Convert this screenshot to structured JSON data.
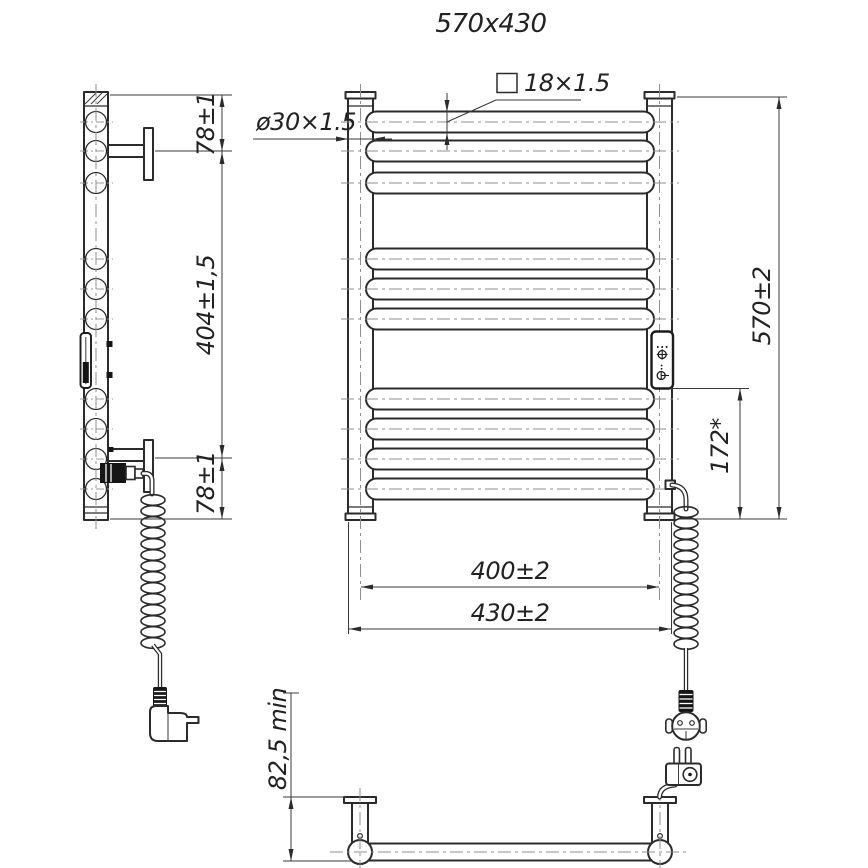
{
  "title": "570x430",
  "drawing": {
    "labels": {
      "tube_section": "18×1.5",
      "post_diameter": "ø30×1.5",
      "overall_height": "570±2",
      "panel_to_bottom": "172*",
      "mounting_width": "400±2",
      "overall_width": "430±2",
      "side_top_offset": "78±1",
      "side_bracket_span": "404±1,5",
      "side_bottom_offset": "78±1",
      "wall_distance": "82,5 min"
    }
  }
}
